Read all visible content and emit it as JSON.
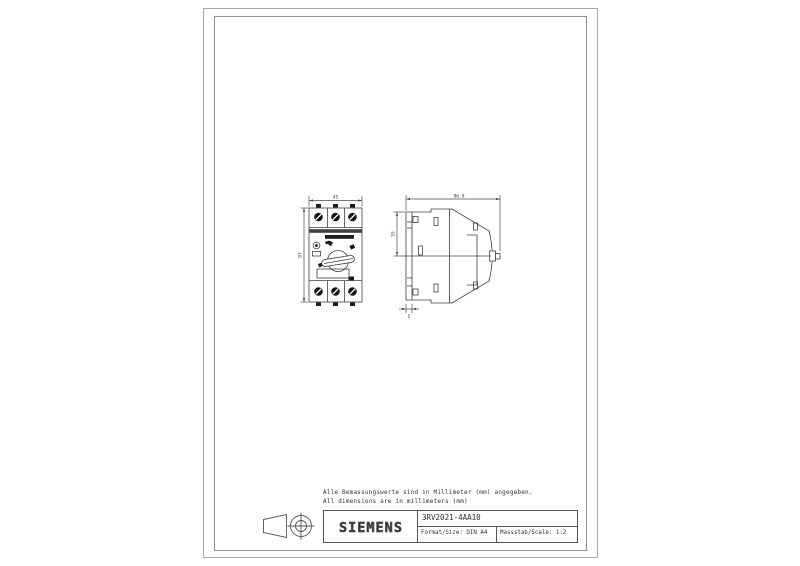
{
  "sheet": {
    "notes": {
      "line1": "Alle Bemassungswerte sind in Millimeter (mm) angegeben.",
      "line2": "All dimensions are in millimeters (mm)"
    },
    "title_block": {
      "brand": "SIEMENS",
      "part_number": "3RV2021-4AA10",
      "format_label": "Format/Size: DIN A4",
      "scale_label": "Massstab/Scale: 1:2"
    }
  },
  "dimensions": {
    "front_width": "45",
    "front_height": "97",
    "side_depth": "96.9",
    "side_upper": "55",
    "side_bottom": "5"
  },
  "colors": {
    "line": "#3f3f3f",
    "dim_line": "#4a4a4a",
    "page_border": "#a9a9a9",
    "background": "#ffffff"
  }
}
